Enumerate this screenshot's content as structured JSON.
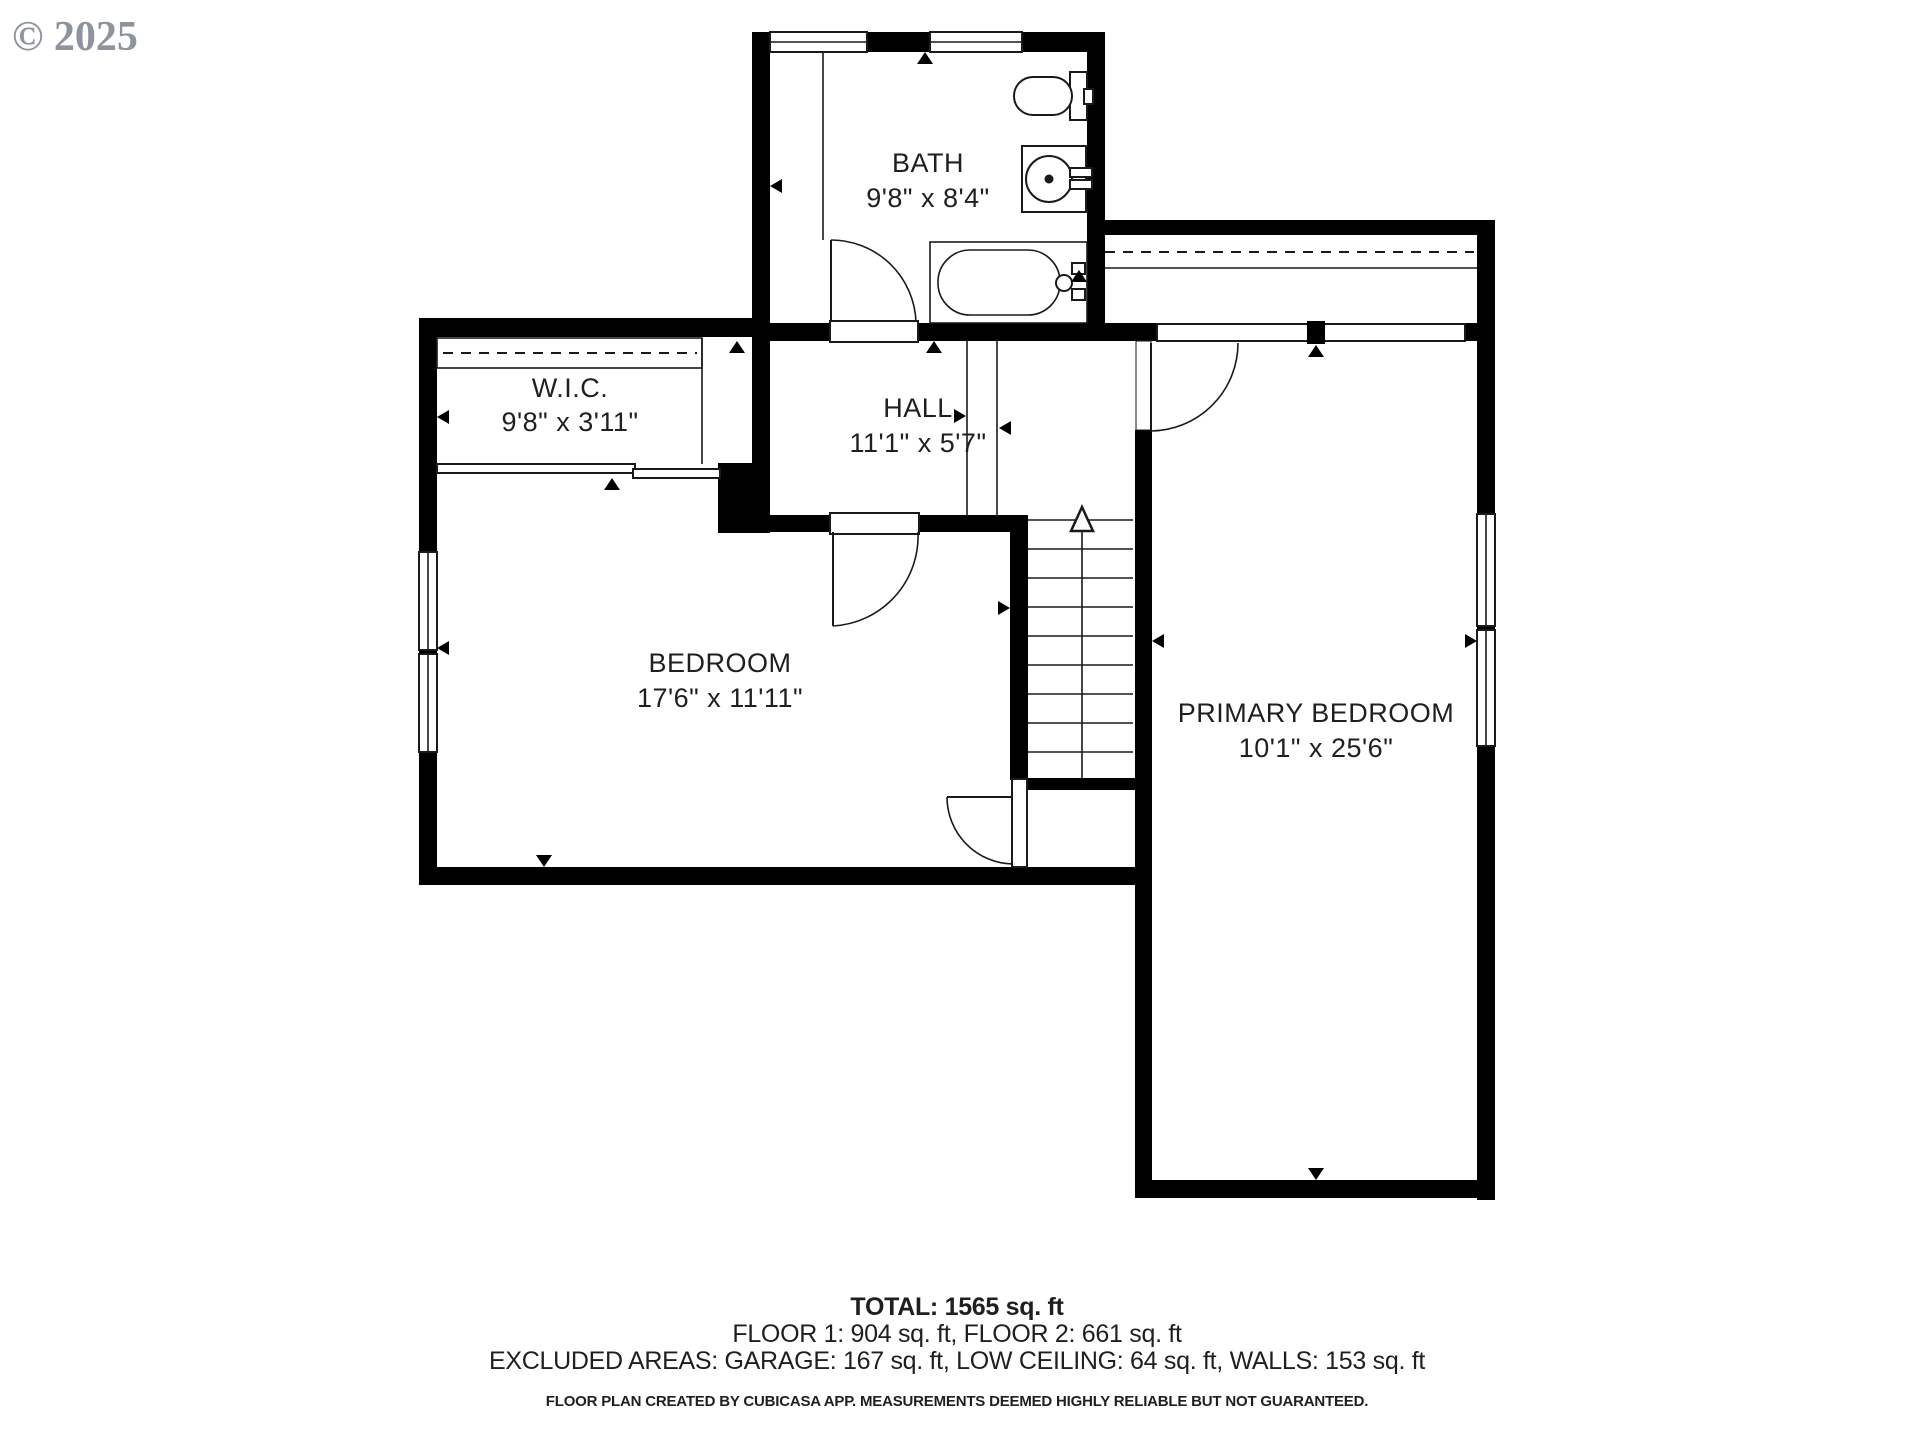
{
  "copyright": "© 2025",
  "rooms": {
    "bath": {
      "name": "BATH",
      "dims": "9'8\" x 8'4\""
    },
    "wic": {
      "name": "W.I.C.",
      "dims": "9'8\" x 3'11\""
    },
    "hall": {
      "name": "HALL",
      "dims": "11'1\" x 5'7\""
    },
    "bedroom": {
      "name": "BEDROOM",
      "dims": "17'6\" x 11'11\""
    },
    "primary": {
      "name": "PRIMARY BEDROOM",
      "dims": "10'1\" x 25'6\""
    }
  },
  "summary": {
    "total": "TOTAL: 1565 sq. ft",
    "floors": "FLOOR 1: 904 sq. ft, FLOOR 2: 661 sq. ft",
    "excluded": "EXCLUDED AREAS: GARAGE: 167 sq. ft, LOW CEILING: 64 sq. ft, WALLS: 153 sq. ft",
    "disclaimer": "FLOOR PLAN CREATED BY CUBICASA APP. MEASUREMENTS DEEMED HIGHLY RELIABLE BUT NOT GUARANTEED."
  },
  "colors": {
    "wall": "#000000",
    "background": "#ffffff",
    "text": "#1f1f1f",
    "copyright": "#8d949d"
  }
}
